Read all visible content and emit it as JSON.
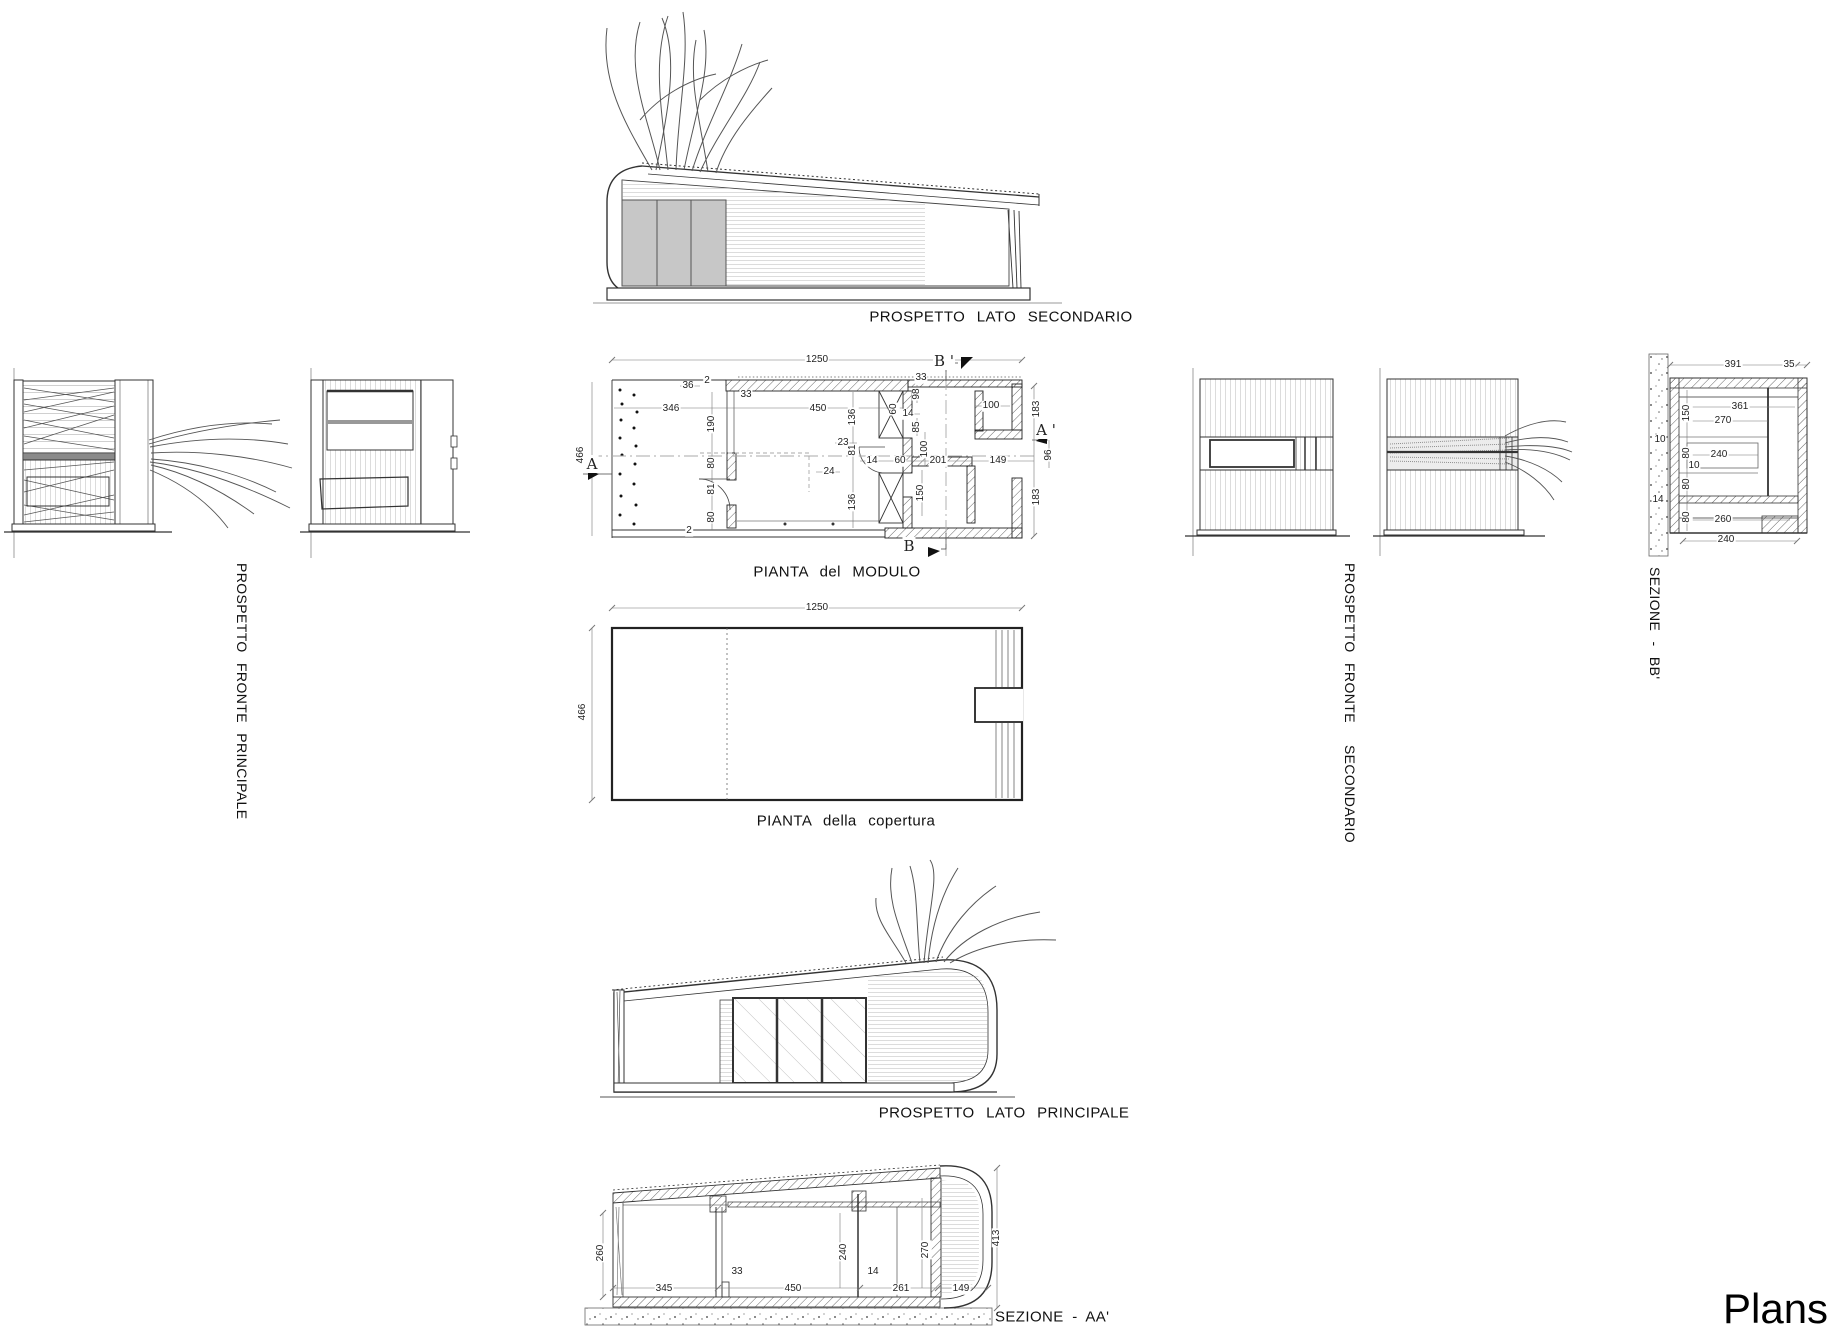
{
  "page": {
    "title": "Plans"
  },
  "labels": {
    "top_elevation": "PROSPETTO LATO SECONDARIO",
    "plan": "PIANTA del MODULO",
    "roof": "PIANTA della copertura",
    "front_principale": "PROSPETTO FRONTE PRINCIPALE",
    "front_secondario_1": "PROSPETTO FRONTE",
    "front_secondario_2": "SECONDARIO",
    "sezione_bb": "SEZIONE - BB'",
    "sezione_aa": "SEZIONE - AA'",
    "bottom_elevation": "PROSPETTO LATO PRINCIPALE"
  },
  "markers": {
    "a": "A",
    "a_prime": "A '",
    "b": "B",
    "b_prime": "B '"
  },
  "plan_dims": [
    "1250",
    "466",
    "36",
    "2",
    "33",
    "346",
    "190",
    "80",
    "81",
    "80",
    "2",
    "450",
    "136",
    "60",
    "33",
    "98",
    "14",
    "85",
    "100",
    "100",
    "183",
    "23",
    "81",
    "24",
    "14",
    "60",
    "201",
    "149",
    "96",
    "183",
    "150",
    "136"
  ],
  "roof_dims": [
    "1250",
    "466"
  ],
  "bb_dims": [
    "391",
    "35",
    "361",
    "270",
    "150",
    "10",
    "80",
    "240",
    "10",
    "80",
    "14",
    "80",
    "260",
    "240"
  ],
  "aa_dims": [
    "260",
    "345",
    "33",
    "450",
    "240",
    "14",
    "261",
    "270",
    "149",
    "413"
  ]
}
